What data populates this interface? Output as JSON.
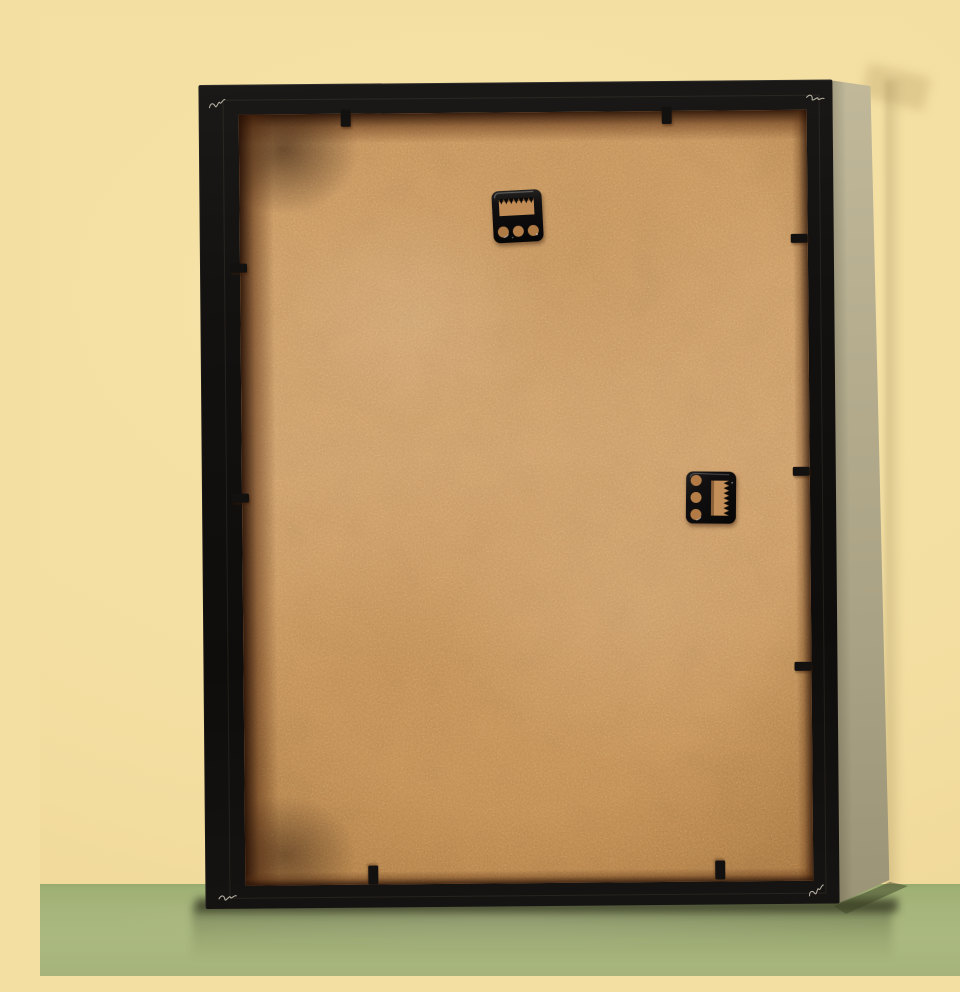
{
  "image": {
    "type": "product-photo",
    "subject": "back of a black picture frame",
    "alt": "Rear view of an empty black picture frame with a natural MDF backing board, two glossy black sawtooth hangers, and black flexible retaining tabs, leaning against a pale yellow wall on an olive green surface"
  },
  "colors": {
    "wall": "#f4dfa2",
    "wall_hi": "#f7e3a8",
    "wall_lo": "#eed696",
    "floor": "#a6b57b",
    "floor_lo": "#a0b175",
    "frame_black": "#131110",
    "frame_side": "#b3ab8c",
    "backing": "#cf9d68",
    "rebate_shadow": "#59300f",
    "hardware": "#0c0a09",
    "scratch": "#d9d3c4"
  },
  "hardware": {
    "portrait_hanger": "sawtooth hanger plate with 3 nail holes, top center",
    "landscape_hanger": "sawtooth hanger plate rotated 90 degrees with 3 nail holes, right middle",
    "retaining_tabs": {
      "top": 2,
      "bottom": 2,
      "left": 2,
      "right": 3
    }
  }
}
